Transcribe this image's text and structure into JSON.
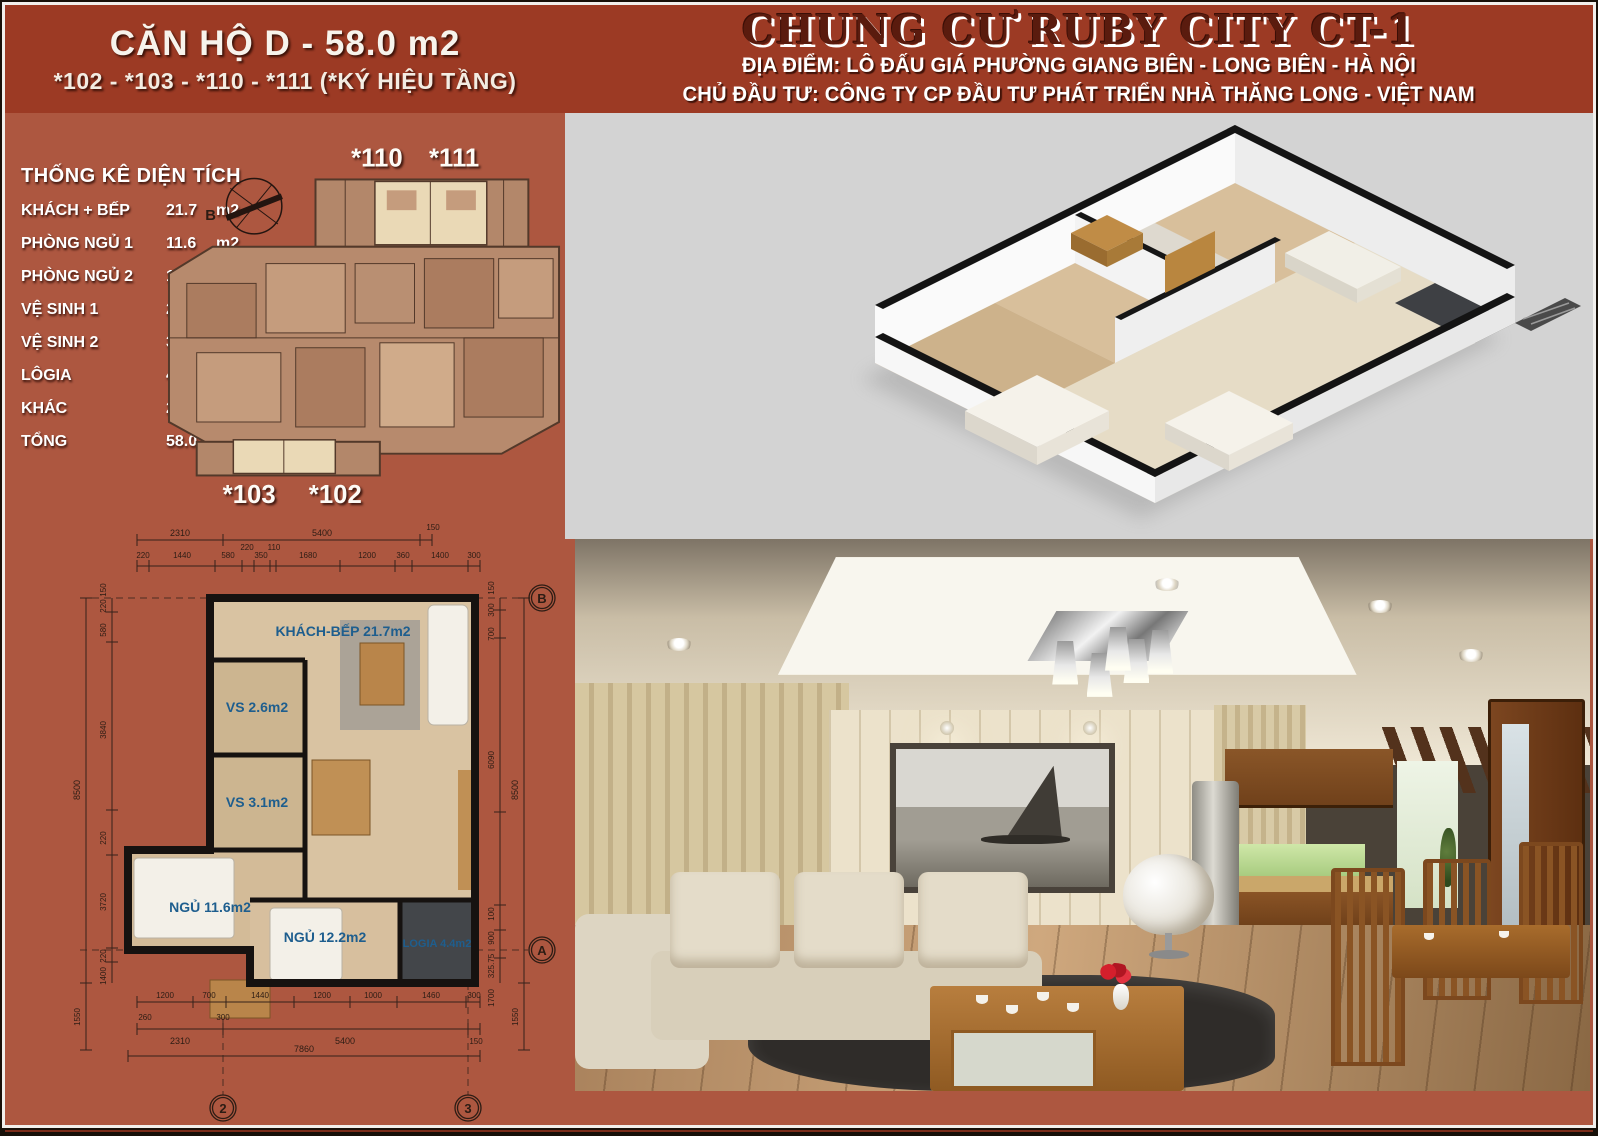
{
  "left_header": {
    "line1": "CĂN HỘ D - 58.0 m2",
    "line2": "*102 - *103 - *110 - *111 (*KÝ HIỆU TẦNG)"
  },
  "right_header": {
    "title": "CHUNG CƯ RUBY CITY CT-1",
    "line1": "ĐỊA ĐIỂM: LÔ ĐẤU GIÁ PHƯỜNG GIANG BIÊN - LONG BIÊN - HÀ NỘI",
    "line2": "CHỦ ĐẦU TƯ: CÔNG TY CP ĐẦU TƯ PHÁT TRIỂN NHÀ THĂNG LONG - VIỆT NAM"
  },
  "area_table": {
    "title": "THỐNG KÊ DIỆN TÍCH",
    "rows": [
      {
        "label": "KHÁCH + BẾP",
        "value": "21.7",
        "unit": "m2"
      },
      {
        "label": "PHÒNG NGỦ 1",
        "value": "11.6",
        "unit": "m2"
      },
      {
        "label": "PHÒNG NGỦ 2",
        "value": "12.2",
        "unit": "m2"
      },
      {
        "label": "VỆ SINH 1",
        "value": "2.6",
        "unit": "m2"
      },
      {
        "label": "VỆ SINH 2",
        "value": "3.1",
        "unit": "m2"
      },
      {
        "label": "LÔGIA",
        "value": "4.4",
        "unit": "m2"
      },
      {
        "label": "KHÁC",
        "value": "2.4",
        "unit": "m2"
      },
      {
        "label": "TỔNG",
        "value": "58.0",
        "unit": "m2"
      }
    ]
  },
  "overview_plan": {
    "units_top": [
      "*110",
      "*111"
    ],
    "units_bottom": [
      "*103",
      "*102"
    ],
    "compass": "B"
  },
  "detail_plan": {
    "rooms": [
      "KHÁCH-BẾP 21.7m2",
      "VS 2.6m2",
      "VS 3.1m2",
      "NGỦ 11.6m2",
      "NGỦ 12.2m2",
      "LOGIA 4.4m2"
    ],
    "grid": {
      "top_right": "B",
      "bottom_right": "A",
      "col_left": "2",
      "col_right": "3"
    },
    "dims": {
      "top1": [
        "2310",
        "5400",
        "150"
      ],
      "top2": [
        "220",
        "1440",
        "580",
        "220",
        "350",
        "110",
        "1680",
        "1200",
        "360",
        "1400",
        "300"
      ],
      "bottom1": [
        "1200",
        "700",
        "1440",
        "1200",
        "1000",
        "1460",
        "300"
      ],
      "bottom2": [
        "260",
        "300"
      ],
      "bottom3": [
        "2310",
        "5400",
        "150"
      ],
      "bottom_total": "7860",
      "left": [
        "150",
        "220",
        "580",
        "3840",
        "220",
        "3720",
        "220",
        "1400"
      ],
      "left_total": "8500",
      "left_bottom": "1550",
      "right": [
        "150",
        "300",
        "700",
        "6090",
        "100",
        "900",
        "325.75",
        "1700"
      ],
      "right_total": "8500",
      "right_bottom": "1550"
    }
  },
  "colors": {
    "panel_red": "#ad5740",
    "header_red": "#9c3a24",
    "title_maroon": "#5a1b0e",
    "room_label_blue": "#1e5e8e",
    "iso_bg": "#d3d3d3"
  }
}
